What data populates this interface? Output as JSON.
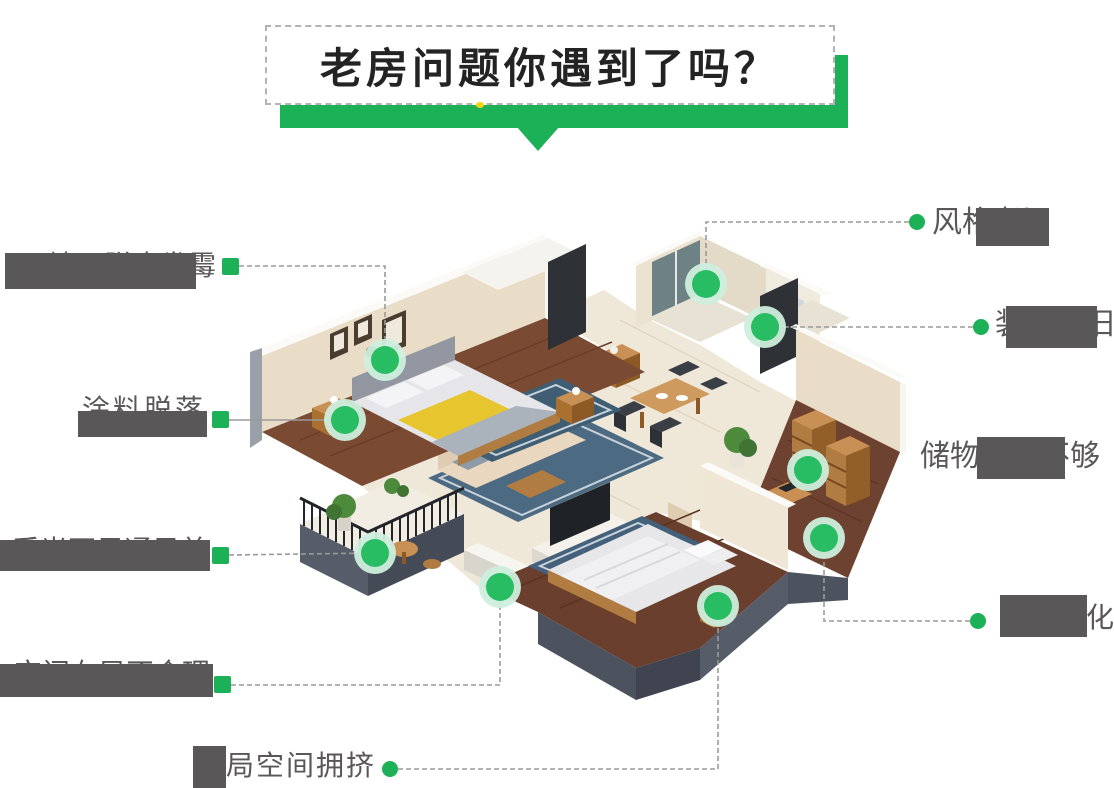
{
  "title": {
    "text": "老房问题你遇到了吗？"
  },
  "colors": {
    "accent_green": "#1cb157",
    "hotspot_inner": "#28bd62",
    "hotspot_ring": "#cdeedd",
    "label_gray": "#595757",
    "line_gray": "#9a9a9a"
  },
  "callouts": [
    {
      "id": "wall-mold",
      "text": "墙面脱皮发霉",
      "side": "left",
      "marker": "square",
      "line": "dashed",
      "obscured": true
    },
    {
      "id": "paint-peel",
      "text": "涂料脱落",
      "side": "left",
      "marker": "square",
      "line": "solid",
      "obscured": true
    },
    {
      "id": "poor-lighting",
      "text": "采光不足通风差",
      "side": "left",
      "marker": "square",
      "line": "dashed",
      "obscured": true
    },
    {
      "id": "bad-layout",
      "text": "空间布局不合理",
      "side": "left",
      "marker": "square",
      "line": "dashed",
      "obscured": true
    },
    {
      "id": "crowded",
      "text": "布局空间拥挤",
      "side": "bottom",
      "marker": "circle",
      "line": "dashed",
      "obscured": true
    },
    {
      "id": "old-style",
      "text": "风格老旧",
      "side": "right",
      "marker": "circle",
      "line": "dashed",
      "obscured": true
    },
    {
      "id": "old-decor",
      "text": "装修陈旧",
      "side": "right",
      "marker": "circle",
      "line": "dashed",
      "obscured": true
    },
    {
      "id": "no-storage",
      "text": "储物空间不够",
      "side": "right",
      "marker": "none",
      "line": "none",
      "obscured": true
    },
    {
      "id": "aging-pipes",
      "text": "水电老化",
      "side": "right",
      "marker": "circle",
      "line": "dashed",
      "obscured": true
    }
  ]
}
